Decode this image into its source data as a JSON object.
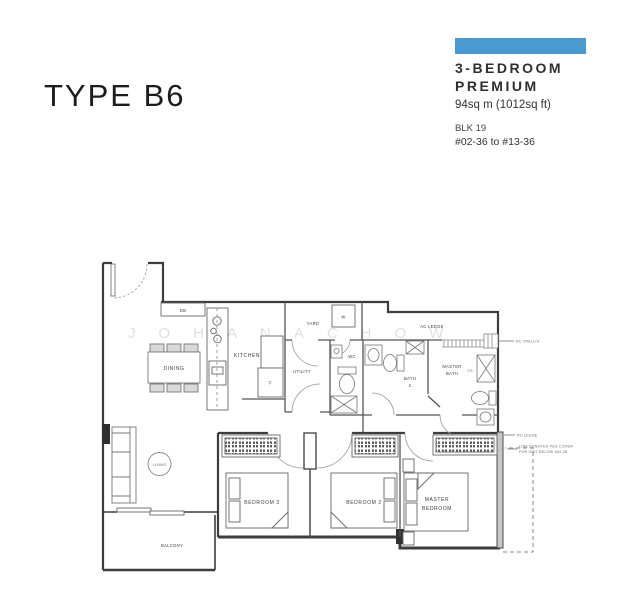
{
  "header": {
    "type_title": "TYPE B6",
    "unit_type_line1": "3-BEDROOM",
    "unit_type_line2": "PREMIUM",
    "area": "94sq m (1012sq ft)",
    "block": "BLK 19",
    "units": "#02-36 to #13-36",
    "accent_color": "#4a9ad2"
  },
  "plan": {
    "watermark": "JOHANACHOW",
    "rooms": {
      "dining": "DINING",
      "kitchen": "KITCHEN",
      "yard": "YARD",
      "utility": "UTILITY",
      "wc": "WC",
      "bath2_line1": "BATH",
      "bath2_line2": "2",
      "master_bath_line1": "MASTER",
      "master_bath_line2": "BATH",
      "ac_ledge": "AC LEDGE",
      "living": "LIVING",
      "bedroom3": "BEDROOM 3",
      "bedroom2": "BEDROOM 2",
      "master_bedroom_line1": "MASTER",
      "master_bedroom_line2": "BEDROOM",
      "balcony": "BALCONY"
    },
    "fixtures": {
      "db": "DB",
      "washer": "W",
      "fridge": "F",
      "cs": "CS"
    },
    "annotations": {
      "rc_trellis": "RC TRELLIS",
      "rc_ledge": "RC LEDGE",
      "pes_note_line1": "LINE DENOTES PES COVER",
      "pes_note_line2": "FOR UNIT BELOW #02-36"
    }
  }
}
